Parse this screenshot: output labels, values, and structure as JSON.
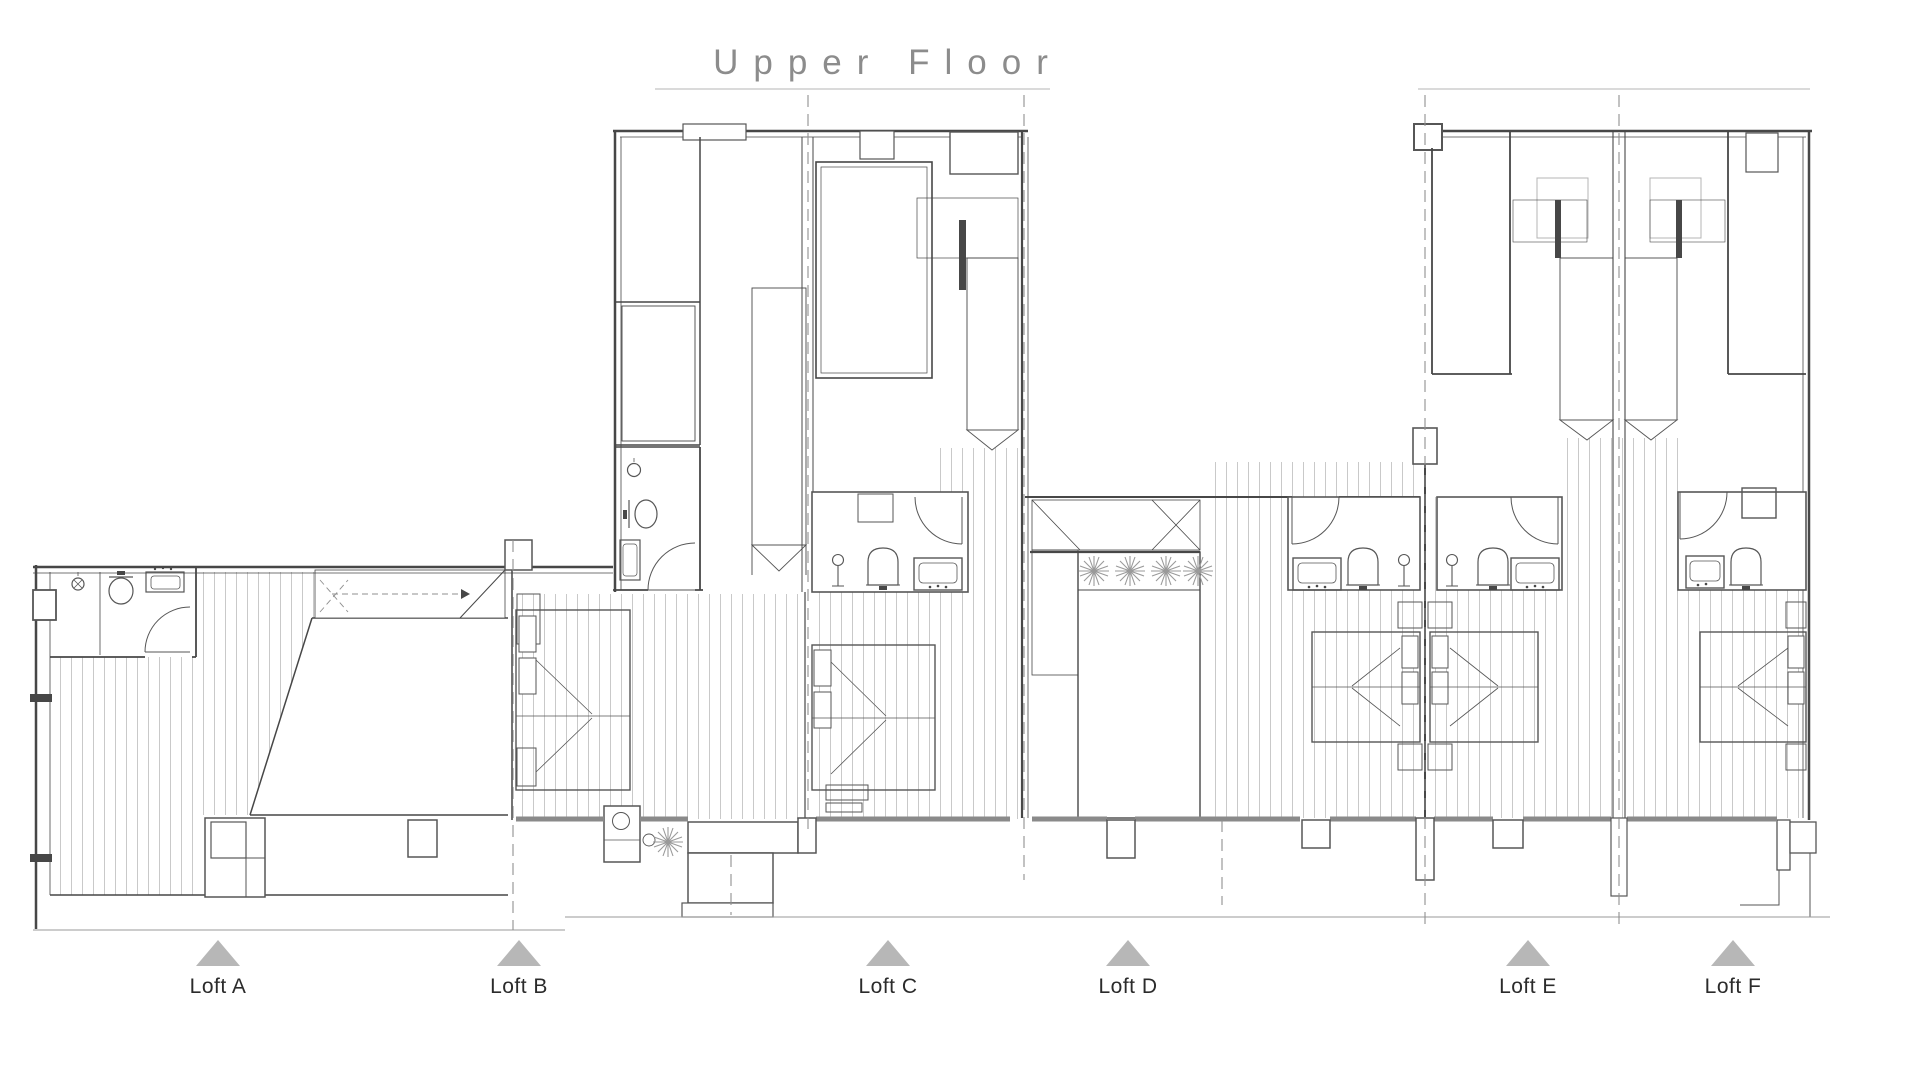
{
  "title": "Upper Floor",
  "lofts": [
    {
      "id": "A",
      "label": "Loft A",
      "marker": "triangle-up"
    },
    {
      "id": "B",
      "label": "Loft B",
      "marker": "triangle-up"
    },
    {
      "id": "C",
      "label": "Loft C",
      "marker": "triangle-up"
    },
    {
      "id": "D",
      "label": "Loft D",
      "marker": "triangle-up"
    },
    {
      "id": "E",
      "label": "Loft E",
      "marker": "triangle-up"
    },
    {
      "id": "F",
      "label": "Loft F",
      "marker": "triangle-up"
    }
  ],
  "colors": {
    "wall": "#474747",
    "hatchline": "#c3c3c3",
    "treadline": "#6e6e6e",
    "dash": "#8f8f8f",
    "band": "#8a8a8a",
    "fixture": "#565656",
    "casework": "#b4b4b4",
    "plant": "#9a9a9a",
    "marker": "#b7b7b7",
    "title": "#8c8c8c",
    "label": "#2b2b2b",
    "ground": "#9a9a9a"
  }
}
